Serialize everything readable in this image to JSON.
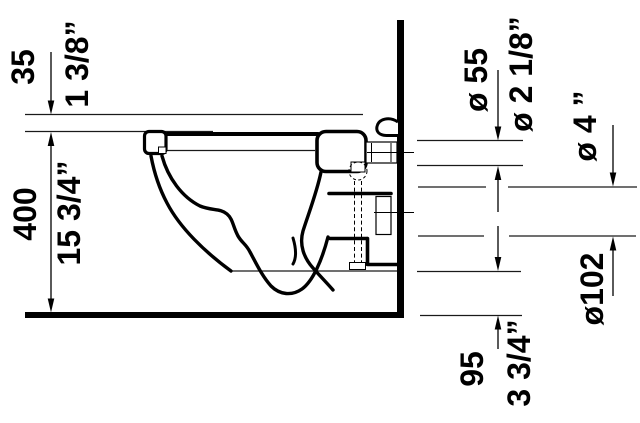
{
  "drawing": {
    "type": "technical-drawing",
    "subject": "wall-hung-toilet-side-section",
    "colors": {
      "line": "#000000",
      "background": "#ffffff"
    },
    "dimensions": {
      "rim_drop": {
        "metric": "35",
        "imperial": "1 3/8”"
      },
      "rim_height": {
        "metric": "400",
        "imperial": "15 3/4”"
      },
      "inlet_diameter": {
        "metric": "ø 55",
        "imperial": "ø 2 1/8”"
      },
      "outlet_diameter": {
        "metric": "ø102",
        "imperial": "ø 4 ”"
      },
      "outlet_floor_clearance": {
        "metric": "95",
        "imperial": "3 3/4”"
      }
    }
  }
}
